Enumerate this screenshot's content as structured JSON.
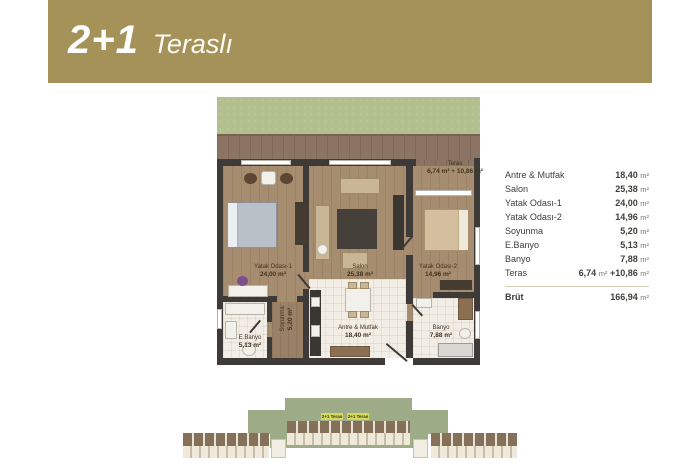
{
  "header": {
    "title_bold": "2+1",
    "title_light": "Teraslı"
  },
  "plan": {
    "terrace": {
      "name": "Teras",
      "area": "6,74 m² + 10,86 m²"
    },
    "rooms": {
      "yatak1": {
        "name": "Yatak Odası-1",
        "area": "24,00 m²"
      },
      "salon": {
        "name": "Salon",
        "area": "25,38 m²"
      },
      "yatak2": {
        "name": "Yatak Odası-2",
        "area": "14,96 m²"
      },
      "soyunma": {
        "name": "Soyunma",
        "area": "5,20 m²"
      },
      "ebanyo": {
        "name": "E.Banyo",
        "area": "5,13 m²"
      },
      "antre": {
        "name": "Antre & Mutfak",
        "area": "18,40 m²"
      },
      "banyo": {
        "name": "Banyo",
        "area": "7,88 m²"
      }
    }
  },
  "table": {
    "rows": [
      {
        "label": "Antre & Mutfak",
        "num": "18,40",
        "unit": "m²"
      },
      {
        "label": "Salon",
        "num": "25,38",
        "unit": "m²"
      },
      {
        "label": "Yatak Odası-1",
        "num": "24,00",
        "unit": "m²"
      },
      {
        "label": "Yatak Odası-2",
        "num": "14,96",
        "unit": "m²"
      },
      {
        "label": "Soyunma",
        "num": "5,20",
        "unit": "m²"
      },
      {
        "label": "E.Banyo",
        "num": "5,13",
        "unit": "m²"
      },
      {
        "label": "Banyo",
        "num": "7,88",
        "unit": "m²"
      },
      {
        "label": "Teras",
        "num": "6,74",
        "unit": "m²",
        "num2": "+10,86",
        "unit2": "m²"
      }
    ],
    "total": {
      "label": "Brüt",
      "num": "166,94",
      "unit": "m²"
    }
  },
  "keyplan": {
    "chip1": "2+1 Teras",
    "chip2": "2+1 Teras"
  },
  "colors": {
    "banner": "#a59258",
    "grass": "#b2c090",
    "wood": "#a68d6f",
    "wall": "#3e3a37",
    "tile": "#f3eee5",
    "keyplan_green": "#9dab86",
    "chip_yellow": "#d7d95b"
  }
}
